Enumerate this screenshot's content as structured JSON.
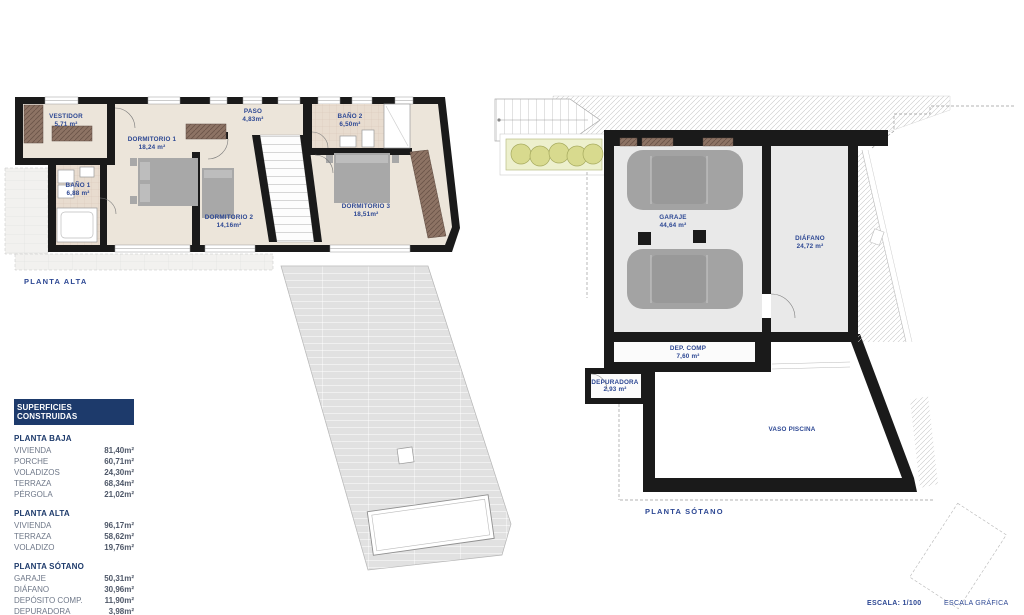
{
  "document": {
    "plan_alta_title": "PLANTA ALTA",
    "plan_sotano_title": "PLANTA  SÓTANO"
  },
  "rooms_alta": {
    "vestidor": {
      "name": "VESTIDOR",
      "area": "5,71 m²"
    },
    "dormitorio1": {
      "name": "DORMITORIO 1",
      "area": "18,24 m²"
    },
    "paso": {
      "name": "PASO",
      "area": "4,83m²"
    },
    "bano1": {
      "name": "BAÑO 1",
      "area": "6,88 m²"
    },
    "dormitorio2": {
      "name": "DORMITORIO 2",
      "area": "14,16m²"
    },
    "bano2": {
      "name": "BAÑO 2",
      "area": "6,50m²"
    },
    "dormitorio3": {
      "name": "DORMITORIO 3",
      "area": "18,51m²"
    }
  },
  "rooms_sotano": {
    "garaje": {
      "name": "GARAJE",
      "area": "44,64 m²"
    },
    "diafano": {
      "name": "DIÁFANO",
      "area": "24,72 m²"
    },
    "dep_comp": {
      "name": "DEP. COMP",
      "area": "7,60 m²"
    },
    "depuradora": {
      "name": "DEPURADORA",
      "area": "2,93 m²"
    },
    "vaso_piscina": {
      "name": "VASO PISCINA"
    }
  },
  "table": {
    "header": "SUPERFICIES CONSTRUIDAS",
    "sections": [
      {
        "title": "PLANTA BAJA",
        "rows": [
          [
            "VIVIENDA",
            "81,40m²"
          ],
          [
            "PORCHE",
            "60,71m²"
          ],
          [
            "VOLADIZOS",
            "24,30m²"
          ],
          [
            "TERRAZA",
            "68,34m²"
          ],
          [
            "PÉRGOLA",
            "21,02m²"
          ]
        ]
      },
      {
        "title": "PLANTA ALTA",
        "rows": [
          [
            "VIVIENDA",
            "96,17m²"
          ],
          [
            "TERRAZA",
            "58,62m²"
          ],
          [
            "VOLADIZO",
            "19,76m²"
          ]
        ]
      },
      {
        "title": "PLANTA SÓTANO",
        "rows": [
          [
            "GARAJE",
            "50,31m²"
          ],
          [
            "DIÁFANO",
            "30,96m²"
          ],
          [
            "DEPÓSITO COMP.",
            "11,90m²"
          ],
          [
            "DEPURADORA",
            "3,98m²"
          ],
          [
            "VOLADIZO",
            "8,72m²"
          ]
        ]
      }
    ]
  },
  "footer": {
    "escala": "ESCALA:  1/100",
    "escala_grafica": "ESCALA GRÁFICA"
  },
  "colors": {
    "label_blue": "#2c4793",
    "table_header_navy": "#1d3a6b",
    "wall_black": "#1a1a1a",
    "floor_beige": "#ece5da",
    "bath_tile": "#e8dccf",
    "furniture_gray": "#a3a3a3",
    "terrace_gray": "#e1e1e1",
    "planter_green": "#d8da8e"
  }
}
